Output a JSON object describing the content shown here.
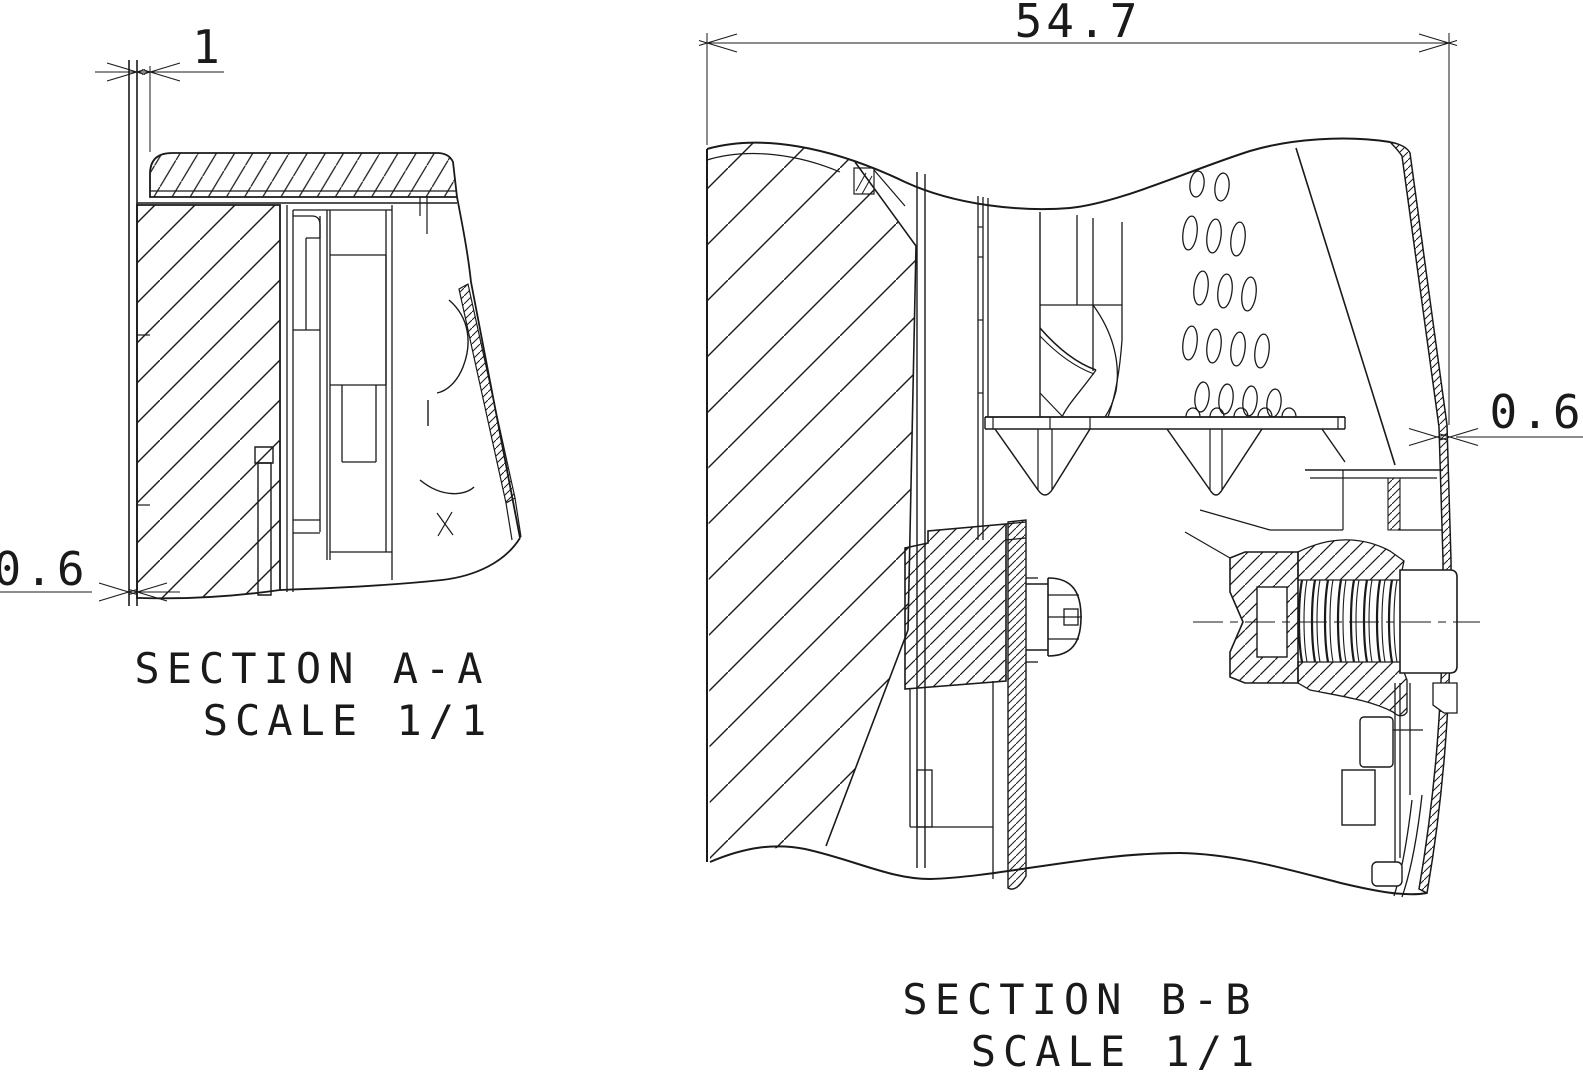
{
  "drawing": {
    "background_color": "#ffffff",
    "line_color": "#1a1a1a",
    "type": "engineering-section-drawing",
    "views": [
      {
        "id": "section-a-a",
        "title": "SECTION A-A",
        "scale_label": "SCALE 1/1",
        "dimensions": [
          {
            "id": "dim-gap",
            "label": "1"
          },
          {
            "id": "dim-wall",
            "label": "0.6"
          }
        ]
      },
      {
        "id": "section-b-b",
        "title": "SECTION B-B",
        "scale_label": "SCALE 1/1",
        "dimensions": [
          {
            "id": "dim-overall-width",
            "label": "54.7"
          },
          {
            "id": "dim-wall",
            "label": "0.6"
          }
        ]
      }
    ]
  }
}
